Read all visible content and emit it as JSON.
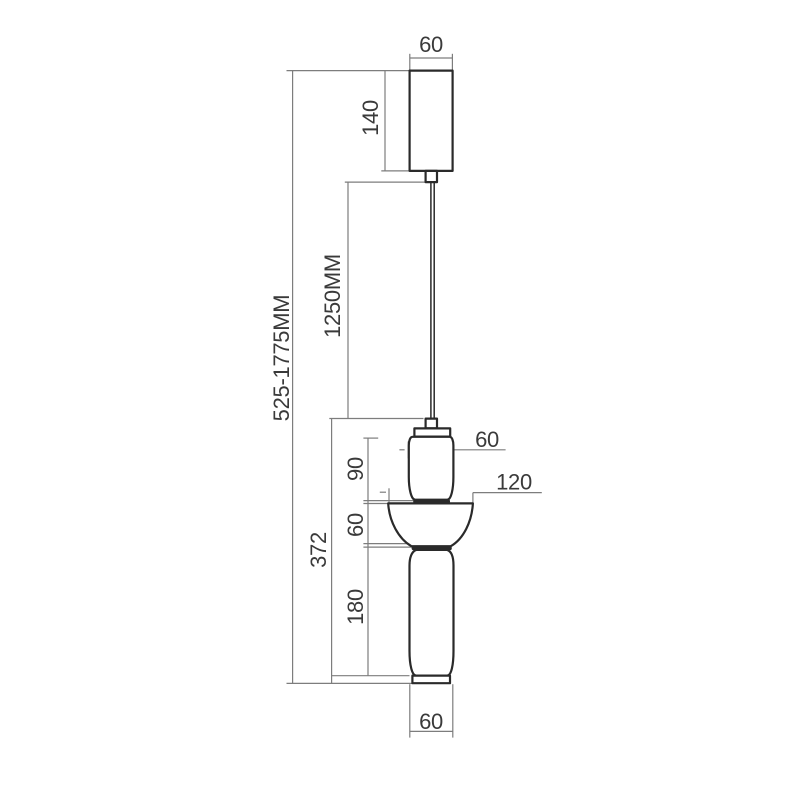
{
  "colors": {
    "background": "#ffffff",
    "outline": "#2a2a2a",
    "dim_line": "#7d7d7d",
    "label": "#3a3a3a"
  },
  "labels": {
    "canopy_width": "60",
    "canopy_height": "140",
    "cable_length": "1250MM",
    "overall_height": "525-1775MM",
    "fixture_height": "372",
    "upper_body_height": "90",
    "upper_body_width": "60",
    "shade_width": "120",
    "shade_height": "60",
    "lower_body_height": "180",
    "base_width": "60"
  }
}
